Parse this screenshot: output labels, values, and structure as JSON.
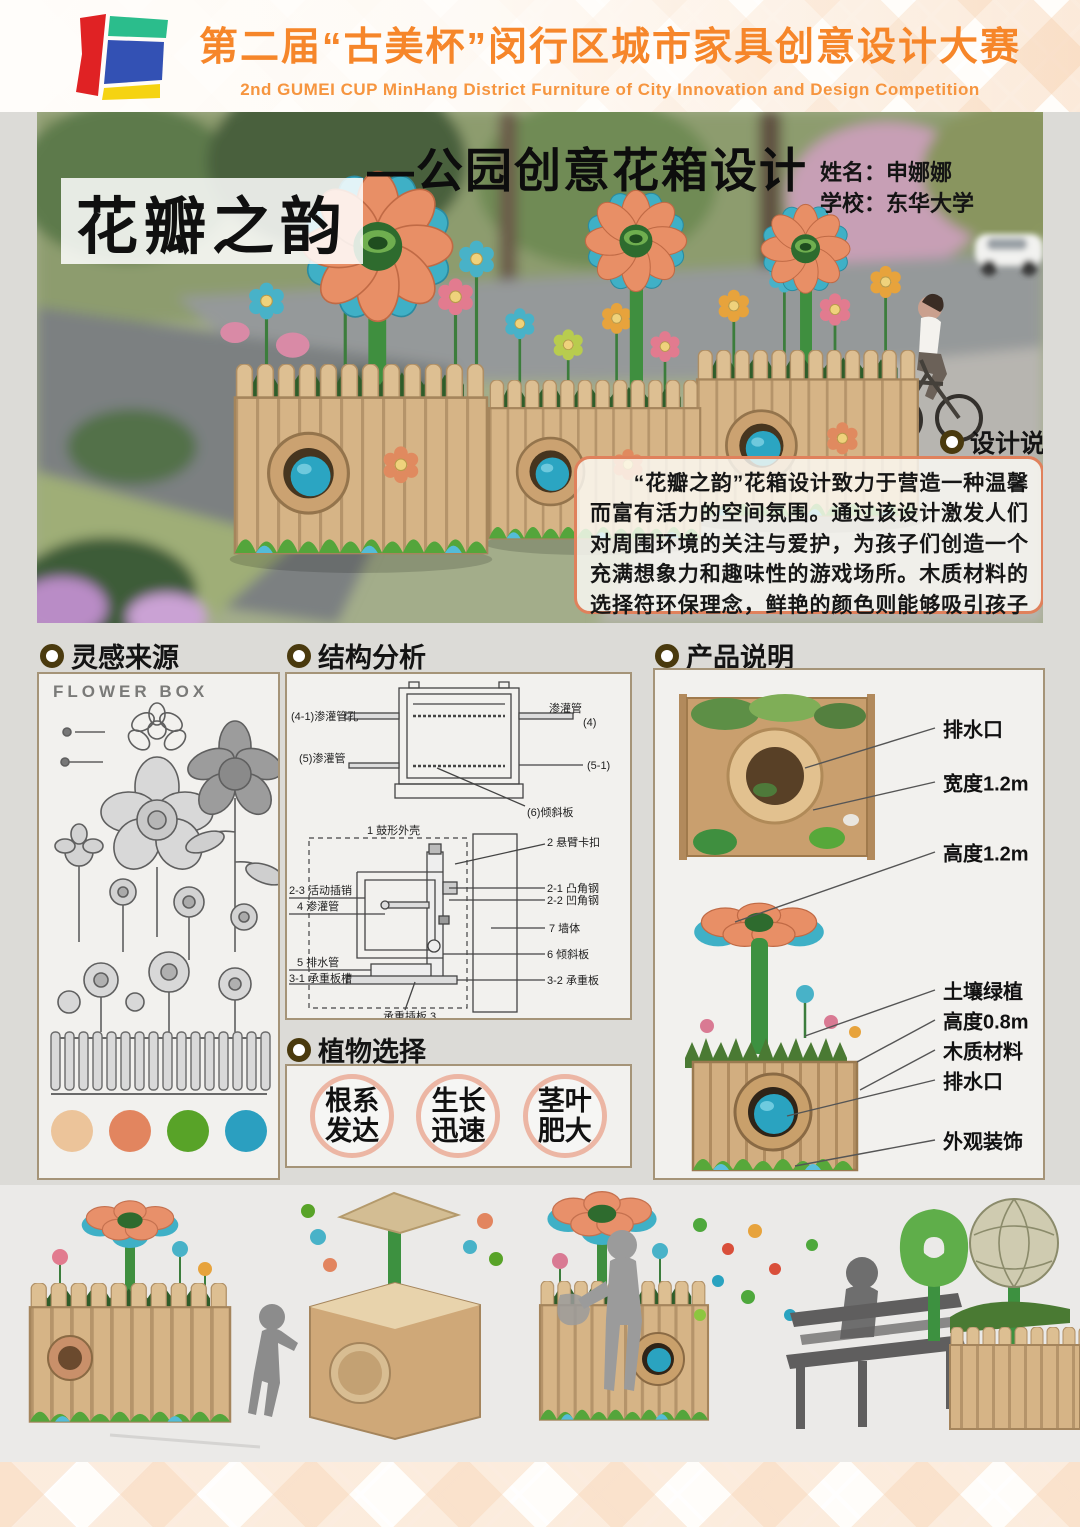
{
  "header": {
    "title": "第二届“古美杯”闵行区城市家具创意设计大赛",
    "subtitle": "2nd GUMEI CUP MinHang District Furniture of City Innovation and Design Competition",
    "accent_color": "#f6862a"
  },
  "hero": {
    "project_title": "花瓣之韵",
    "work_title": "—公园创意花箱设计",
    "author_name": "姓名：申娜娜",
    "author_school": "学校：东华大学"
  },
  "design_note": {
    "heading": "设计说明",
    "body": "　　“花瓣之韵”花箱设计致力于营造一种温馨而富有活力的空间氛围。通过该设计激发人们对周围环境的关注与爱护，为孩子们创造一个充满想象力和趣味性的游戏场所。木质材料的选择符环保理念，鲜艳的颜色则能够吸引孩子们的目光，"
  },
  "inspiration": {
    "heading": "灵感来源",
    "sketch_caption": "FLOWER BOX",
    "palette": [
      "#ecc49a",
      "#e2855f",
      "#58a328",
      "#2b9fc0"
    ]
  },
  "structure": {
    "heading": "结构分析",
    "top_diagram": {
      "label_hole": "(4-1)渗灌管孔",
      "label_pipe_left": "(5)渗灌管",
      "label_pipe_right": "渗灌管",
      "label_4": "(4)",
      "label_5_1": "(5-1)",
      "label_slope": "(6)倾斜板"
    },
    "wall_diagram": {
      "label_shell": "1 鼓形外壳",
      "label_clip": "2 悬臂卡扣",
      "label_pin": "2-3 活动插销",
      "label_pipe": "4 渗灌管",
      "label_convex": "2-1 凸角钢",
      "label_concave": "2-2 凹角钢",
      "label_wall": "7 墙体",
      "label_drain": "5 排水管",
      "label_slope": "6 倾斜板",
      "label_slot": "3-1 承重板槽",
      "label_plate": "3-2 承重板",
      "label_insert": "承重插板 3"
    }
  },
  "plants": {
    "heading": "植物选择",
    "options": [
      "根系发达",
      "生长迅速",
      "茎叶肥大"
    ]
  },
  "product": {
    "heading": "产品说明",
    "labels": [
      "排水口",
      "宽度1.2m",
      "高度1.2m",
      "土壤绿植",
      "高度0.8m",
      "木质材料",
      "排水口",
      "外观装饰"
    ]
  }
}
